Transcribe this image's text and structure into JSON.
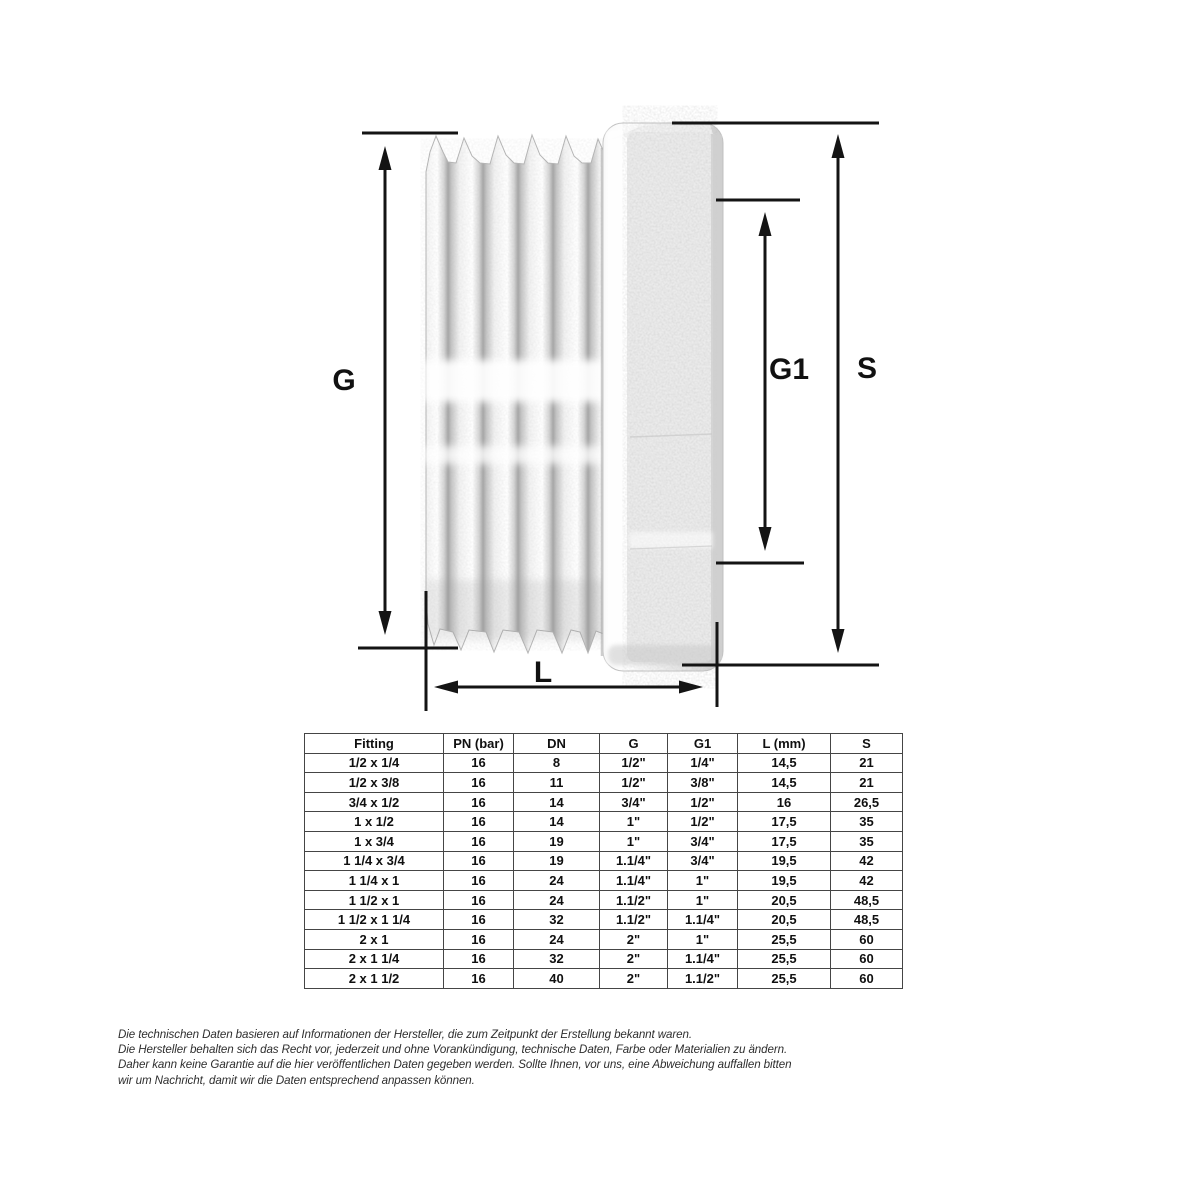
{
  "drawing": {
    "labels": {
      "g": "G",
      "g1": "G1",
      "s": "S",
      "l": "L"
    }
  },
  "table": {
    "headers": [
      "Fitting",
      "PN (bar)",
      "DN",
      "G",
      "G1",
      "L (mm)",
      "S"
    ],
    "rows": [
      [
        "1/2 x 1/4",
        "16",
        "8",
        "1/2\"",
        "1/4\"",
        "14,5",
        "21"
      ],
      [
        "1/2 x 3/8",
        "16",
        "11",
        "1/2\"",
        "3/8\"",
        "14,5",
        "21"
      ],
      [
        "3/4 x 1/2",
        "16",
        "14",
        "3/4\"",
        "1/2\"",
        "16",
        "26,5"
      ],
      [
        "1 x 1/2",
        "16",
        "14",
        "1\"",
        "1/2\"",
        "17,5",
        "35"
      ],
      [
        "1 x 3/4",
        "16",
        "19",
        "1\"",
        "3/4\"",
        "17,5",
        "35"
      ],
      [
        "1 1/4 x 3/4",
        "16",
        "19",
        "1.1/4\"",
        "3/4\"",
        "19,5",
        "42"
      ],
      [
        "1 1/4 x 1",
        "16",
        "24",
        "1.1/4\"",
        "1\"",
        "19,5",
        "42"
      ],
      [
        "1 1/2 x 1",
        "16",
        "24",
        "1.1/2\"",
        "1\"",
        "20,5",
        "48,5"
      ],
      [
        "1 1/2 x 1 1/4",
        "16",
        "32",
        "1.1/2\"",
        "1.1/4\"",
        "20,5",
        "48,5"
      ],
      [
        "2 x 1",
        "16",
        "24",
        "2\"",
        "1\"",
        "25,5",
        "60"
      ],
      [
        "2 x 1 1/4",
        "16",
        "32",
        "2\"",
        "1.1/4\"",
        "25,5",
        "60"
      ],
      [
        "2 x 1 1/2",
        "16",
        "40",
        "2\"",
        "1.1/2\"",
        "25,5",
        "60"
      ]
    ]
  },
  "disclaimer": {
    "lines": [
      "Die technischen Daten basieren auf Informationen der Hersteller, die zum Zeitpunkt der Erstellung bekannt waren.",
      "Die Hersteller behalten sich das Recht vor, jederzeit und ohne Vorankündigung, technische Daten, Farbe oder Materialien zu ändern.",
      "Daher kann keine Garantie auf die hier veröffentlichen Daten gegeben werden. Sollte Ihnen, vor uns, eine Abweichung auffallen bitten",
      "wir um Nachricht, damit wir die Daten entsprechend anpassen können."
    ]
  }
}
